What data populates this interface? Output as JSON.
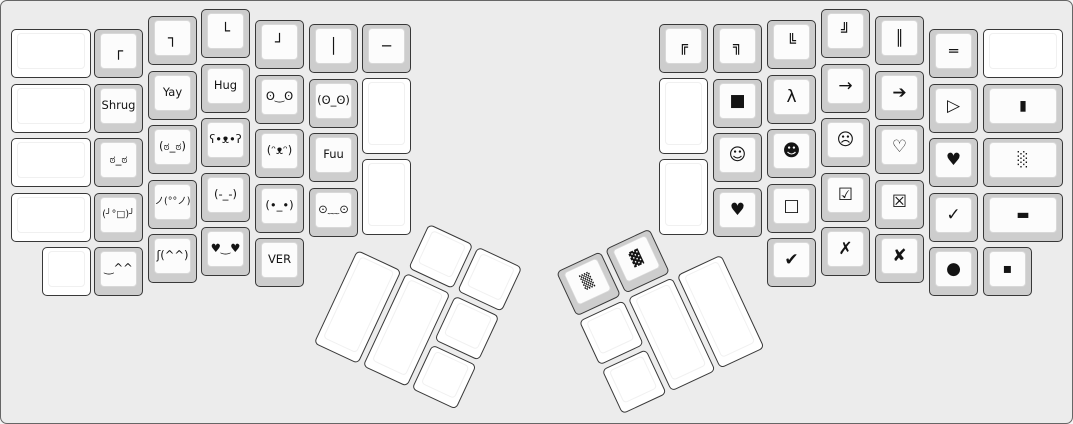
{
  "theme": {
    "canvas_bg": "#ececec",
    "canvas_border": "#666666",
    "cap_base": "#cdcdcd",
    "cap_top": "#fcfcfc",
    "blank_base": "#ffffff",
    "key_border": "#383838",
    "legend_color": "#141414"
  },
  "keyboard": {
    "unit_px": 54.5,
    "groups": [
      {
        "name": "left-main-keys",
        "x": 0,
        "y": 0,
        "rotation": 0,
        "keys": [
          {
            "x": 10,
            "y": 28,
            "w": 80,
            "h": 49,
            "legend": "",
            "cap": "white"
          },
          {
            "x": 10,
            "y": 83,
            "w": 80,
            "h": 49,
            "legend": "",
            "cap": "white"
          },
          {
            "x": 10,
            "y": 137,
            "w": 80,
            "h": 49,
            "legend": "",
            "cap": "white"
          },
          {
            "x": 10,
            "y": 192,
            "w": 80,
            "h": 49,
            "legend": "",
            "cap": "white"
          },
          {
            "x": 41,
            "y": 246,
            "w": 49,
            "h": 49,
            "legend": "",
            "cap": "white"
          },
          {
            "x": 93,
            "y": 28,
            "w": 49,
            "h": 49,
            "legend": "┌",
            "cap": "grey"
          },
          {
            "x": 93,
            "y": 83,
            "w": 49,
            "h": 49,
            "legend": "Shrug",
            "cap": "grey"
          },
          {
            "x": 93,
            "y": 137,
            "w": 49,
            "h": 49,
            "legend": "ಠ_ಠ",
            "cap": "grey"
          },
          {
            "x": 93,
            "y": 192,
            "w": 49,
            "h": 49,
            "legend": "(╯°□)╯",
            "cap": "grey"
          },
          {
            "x": 93,
            "y": 246,
            "w": 49,
            "h": 49,
            "legend": "‿^^",
            "cap": "grey"
          },
          {
            "x": 147,
            "y": 15,
            "w": 49,
            "h": 49,
            "legend": "┐",
            "cap": "grey"
          },
          {
            "x": 147,
            "y": 70,
            "w": 49,
            "h": 49,
            "legend": "Yay",
            "cap": "grey"
          },
          {
            "x": 147,
            "y": 124,
            "w": 49,
            "h": 49,
            "legend": "(ಠ_ಠ)",
            "cap": "grey"
          },
          {
            "x": 147,
            "y": 179,
            "w": 49,
            "h": 49,
            "legend": "ノ(°°ノ)",
            "cap": "grey"
          },
          {
            "x": 147,
            "y": 233,
            "w": 49,
            "h": 49,
            "legend": "ʃ(^^)",
            "cap": "grey"
          },
          {
            "x": 200,
            "y": 8,
            "w": 49,
            "h": 49,
            "legend": "└",
            "cap": "grey"
          },
          {
            "x": 200,
            "y": 63,
            "w": 49,
            "h": 49,
            "legend": "Hug",
            "cap": "grey"
          },
          {
            "x": 200,
            "y": 117,
            "w": 49,
            "h": 49,
            "legend": "ʕ•ᴥ•ʔ",
            "cap": "grey"
          },
          {
            "x": 200,
            "y": 172,
            "w": 49,
            "h": 49,
            "legend": "(-_-)",
            "cap": "grey"
          },
          {
            "x": 200,
            "y": 226,
            "w": 49,
            "h": 49,
            "legend": "♥‿♥",
            "cap": "grey"
          },
          {
            "x": 254,
            "y": 19,
            "w": 49,
            "h": 49,
            "legend": "┘",
            "cap": "grey"
          },
          {
            "x": 254,
            "y": 74,
            "w": 49,
            "h": 49,
            "legend": "ʘ‿ʘ",
            "cap": "grey"
          },
          {
            "x": 254,
            "y": 128,
            "w": 49,
            "h": 49,
            "legend": "(ᵔᴥᵔ)",
            "cap": "grey"
          },
          {
            "x": 254,
            "y": 183,
            "w": 49,
            "h": 49,
            "legend": "(•_•)",
            "cap": "grey"
          },
          {
            "x": 254,
            "y": 237,
            "w": 49,
            "h": 49,
            "legend": "VER",
            "cap": "grey"
          },
          {
            "x": 308,
            "y": 23,
            "w": 49,
            "h": 49,
            "legend": "│",
            "cap": "grey"
          },
          {
            "x": 308,
            "y": 78,
            "w": 49,
            "h": 49,
            "legend": "(ʘ_ʘ)",
            "cap": "grey"
          },
          {
            "x": 308,
            "y": 132,
            "w": 49,
            "h": 49,
            "legend": "Fuu",
            "cap": "grey"
          },
          {
            "x": 308,
            "y": 187,
            "w": 49,
            "h": 49,
            "legend": "⊙﹏⊙",
            "cap": "grey"
          },
          {
            "x": 361,
            "y": 23,
            "w": 49,
            "h": 49,
            "legend": "─",
            "cap": "grey"
          },
          {
            "x": 361,
            "y": 77,
            "w": 49,
            "h": 76,
            "legend": "",
            "cap": "white"
          },
          {
            "x": 361,
            "y": 158,
            "w": 49,
            "h": 76,
            "legend": "",
            "cap": "white"
          }
        ]
      },
      {
        "name": "right-main-keys",
        "x": 0,
        "y": 0,
        "rotation": 0,
        "keys": [
          {
            "x": 658,
            "y": 23,
            "w": 49,
            "h": 49,
            "legend": "╔",
            "cap": "grey"
          },
          {
            "x": 658,
            "y": 77,
            "w": 49,
            "h": 76,
            "legend": "",
            "cap": "white"
          },
          {
            "x": 658,
            "y": 158,
            "w": 49,
            "h": 76,
            "legend": "",
            "cap": "white"
          },
          {
            "x": 712,
            "y": 23,
            "w": 49,
            "h": 49,
            "legend": "╗",
            "cap": "grey"
          },
          {
            "x": 712,
            "y": 78,
            "w": 49,
            "h": 49,
            "legend": "■",
            "cap": "grey"
          },
          {
            "x": 712,
            "y": 132,
            "w": 49,
            "h": 49,
            "legend": "☺",
            "cap": "grey"
          },
          {
            "x": 712,
            "y": 187,
            "w": 49,
            "h": 49,
            "legend": "♥",
            "cap": "grey"
          },
          {
            "x": 766,
            "y": 19,
            "w": 49,
            "h": 49,
            "legend": "╚",
            "cap": "grey"
          },
          {
            "x": 766,
            "y": 74,
            "w": 49,
            "h": 49,
            "legend": "λ",
            "cap": "grey"
          },
          {
            "x": 766,
            "y": 128,
            "w": 49,
            "h": 49,
            "legend": "☻",
            "cap": "grey"
          },
          {
            "x": 766,
            "y": 183,
            "w": 49,
            "h": 49,
            "legend": "□",
            "cap": "grey"
          },
          {
            "x": 766,
            "y": 237,
            "w": 49,
            "h": 49,
            "legend": "✔",
            "cap": "grey"
          },
          {
            "x": 820,
            "y": 8,
            "w": 49,
            "h": 49,
            "legend": "╝",
            "cap": "grey"
          },
          {
            "x": 820,
            "y": 63,
            "w": 49,
            "h": 49,
            "legend": "→",
            "cap": "grey"
          },
          {
            "x": 820,
            "y": 117,
            "w": 49,
            "h": 49,
            "legend": "☹",
            "cap": "grey"
          },
          {
            "x": 820,
            "y": 172,
            "w": 49,
            "h": 49,
            "legend": "☑",
            "cap": "grey"
          },
          {
            "x": 820,
            "y": 226,
            "w": 49,
            "h": 49,
            "legend": "✗",
            "cap": "grey"
          },
          {
            "x": 874,
            "y": 15,
            "w": 49,
            "h": 49,
            "legend": "║",
            "cap": "grey"
          },
          {
            "x": 874,
            "y": 70,
            "w": 49,
            "h": 49,
            "legend": "➔",
            "cap": "grey"
          },
          {
            "x": 874,
            "y": 124,
            "w": 49,
            "h": 49,
            "legend": "♡",
            "cap": "grey"
          },
          {
            "x": 874,
            "y": 179,
            "w": 49,
            "h": 49,
            "legend": "☒",
            "cap": "grey"
          },
          {
            "x": 874,
            "y": 233,
            "w": 49,
            "h": 49,
            "legend": "✘",
            "cap": "grey"
          },
          {
            "x": 928,
            "y": 28,
            "w": 49,
            "h": 49,
            "legend": "═",
            "cap": "grey"
          },
          {
            "x": 928,
            "y": 83,
            "w": 49,
            "h": 49,
            "legend": "▷",
            "cap": "grey"
          },
          {
            "x": 928,
            "y": 137,
            "w": 49,
            "h": 49,
            "legend": "♥",
            "cap": "grey"
          },
          {
            "x": 928,
            "y": 192,
            "w": 49,
            "h": 49,
            "legend": "✓",
            "cap": "grey"
          },
          {
            "x": 928,
            "y": 246,
            "w": 49,
            "h": 49,
            "legend": "●",
            "cap": "grey"
          },
          {
            "x": 982,
            "y": 28,
            "w": 80,
            "h": 49,
            "legend": "",
            "cap": "white"
          },
          {
            "x": 982,
            "y": 83,
            "w": 80,
            "h": 49,
            "legend": "▮",
            "cap": "grey"
          },
          {
            "x": 982,
            "y": 137,
            "w": 80,
            "h": 49,
            "legend": "░",
            "cap": "grey"
          },
          {
            "x": 982,
            "y": 192,
            "w": 80,
            "h": 49,
            "legend": "▬",
            "cap": "grey"
          },
          {
            "x": 982,
            "y": 246,
            "w": 49,
            "h": 49,
            "legend": "▪",
            "cap": "grey"
          }
        ]
      },
      {
        "name": "left-thumb-cluster",
        "x": 379,
        "y": 200,
        "rotation": 25,
        "keys": [
          {
            "x": 54,
            "y": 0,
            "w": 49,
            "h": 49,
            "legend": "",
            "cap": "white"
          },
          {
            "x": 108,
            "y": 0,
            "w": 49,
            "h": 49,
            "legend": "",
            "cap": "white"
          },
          {
            "x": 0,
            "y": 54,
            "w": 49,
            "h": 103,
            "legend": "",
            "cap": "white"
          },
          {
            "x": 54,
            "y": 54,
            "w": 49,
            "h": 103,
            "legend": "",
            "cap": "white"
          },
          {
            "x": 108,
            "y": 54,
            "w": 49,
            "h": 49,
            "legend": "",
            "cap": "white"
          },
          {
            "x": 108,
            "y": 108,
            "w": 49,
            "h": 49,
            "legend": "",
            "cap": "white"
          }
        ]
      },
      {
        "name": "right-thumb-cluster",
        "x": 555,
        "y": 271,
        "rotation": -25,
        "keys": [
          {
            "x": 0,
            "y": 0,
            "w": 49,
            "h": 49,
            "legend": "▒",
            "cap": "grey"
          },
          {
            "x": 54,
            "y": 0,
            "w": 49,
            "h": 49,
            "legend": "▓",
            "cap": "grey"
          },
          {
            "x": 0,
            "y": 54,
            "w": 49,
            "h": 49,
            "legend": "",
            "cap": "white"
          },
          {
            "x": 0,
            "y": 108,
            "w": 49,
            "h": 49,
            "legend": "",
            "cap": "white"
          },
          {
            "x": 54,
            "y": 54,
            "w": 49,
            "h": 103,
            "legend": "",
            "cap": "white"
          },
          {
            "x": 108,
            "y": 54,
            "w": 49,
            "h": 103,
            "legend": "",
            "cap": "white"
          }
        ]
      }
    ]
  }
}
